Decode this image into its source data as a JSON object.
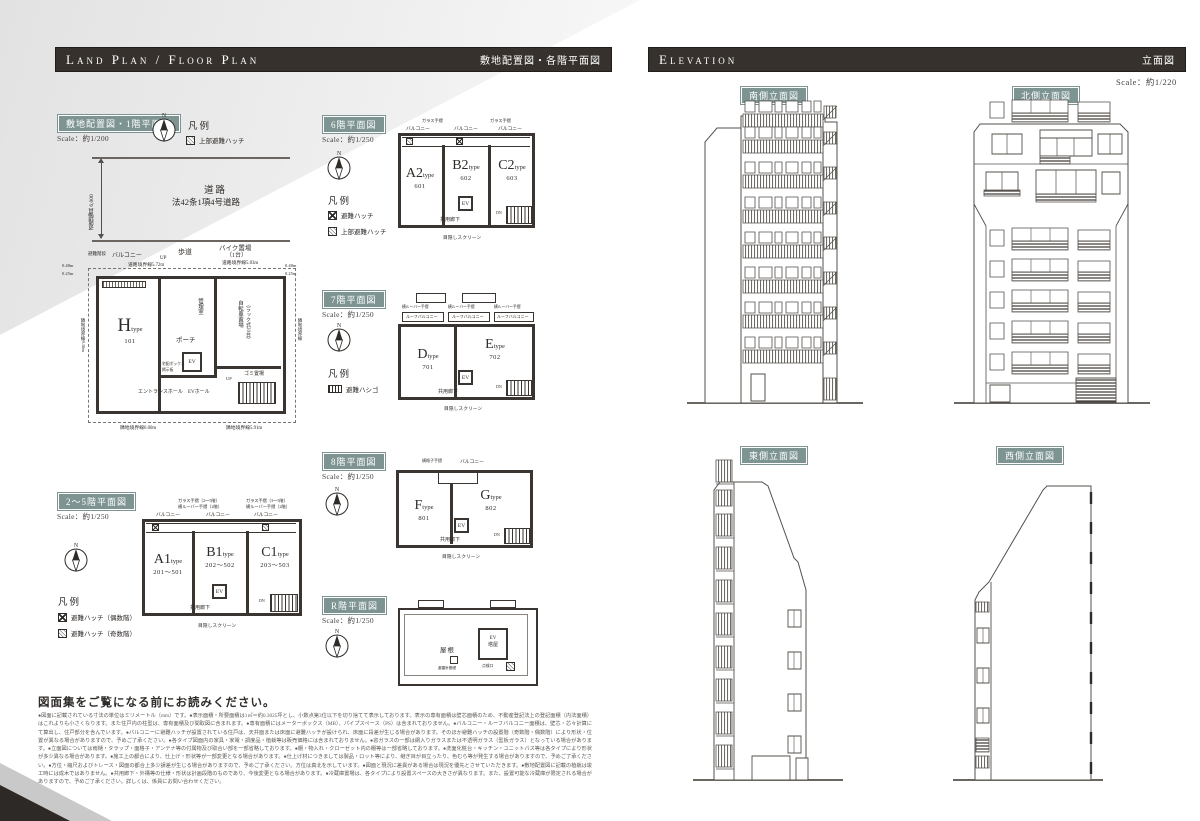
{
  "common": {
    "n": "N",
    "type_word": "type",
    "ev": "EV",
    "corridor": "共用廊下",
    "screen": "目隠しスクリーン",
    "up": "UP",
    "dn": "DN"
  },
  "header": {
    "left_title": "Land Plan / Floor Plan",
    "left_sub": "敷地配置図・各階平面図",
    "right_title": "Elevation",
    "right_sub": "立面図",
    "right_scale": "Scale：約1/220"
  },
  "sections": {
    "site": {
      "label": "敷地配置図・1階平面図",
      "scale": "Scale：約1/200"
    },
    "f25": {
      "label": "2～5階平面図",
      "scale": "Scale：約1/250"
    },
    "f6": {
      "label": "6階平面図",
      "scale": "Scale：約1/250"
    },
    "f7": {
      "label": "7階平面図",
      "scale": "Scale：約1/250"
    },
    "f8": {
      "label": "8階平面図",
      "scale": "Scale：約1/250"
    },
    "fr": {
      "label": "R階平面図",
      "scale": "Scale：約1/250"
    },
    "south": "南側立面図",
    "north": "北側立面図",
    "east": "東側立面図",
    "west": "西側立面図",
    "legend_word": "凡例"
  },
  "legend": {
    "site": [
      "上部避難ハッチ"
    ],
    "f25": [
      "避難ハッチ（偶数階）",
      "避難ハッチ（奇数階）"
    ],
    "f6": [
      "避難ハッチ",
      "上部避難ハッチ"
    ],
    "f7": [
      "避難ハシゴ"
    ]
  },
  "units": {
    "h": {
      "t": "H",
      "n": "101"
    },
    "a1": {
      "t": "A1",
      "n": "201～501"
    },
    "b1": {
      "t": "B1",
      "n": "202～502"
    },
    "c1": {
      "t": "C1",
      "n": "203～503"
    },
    "a2": {
      "t": "A2",
      "n": "601"
    },
    "b2": {
      "t": "B2",
      "n": "602"
    },
    "c2": {
      "t": "C2",
      "n": "603"
    },
    "d": {
      "t": "D",
      "n": "701"
    },
    "e": {
      "t": "E",
      "n": "702"
    },
    "f": {
      "t": "F",
      "n": "801"
    },
    "g": {
      "t": "G",
      "n": "802"
    }
  },
  "site_plan": {
    "road_width": "道路幅員 6,000",
    "road1": "道路",
    "road2": "法42条1項4号道路",
    "sidewalk": "歩道",
    "bike": "バイク置場",
    "bike2": "（1台）",
    "hinan": "避難階段",
    "balcony": "バルコニー",
    "porch": "ポーチ",
    "kanri": "管理室",
    "bicycle": "自転車置場",
    "bicycle2": "（ラック式20台）",
    "evhall": "EVホール",
    "entrance": "エントランスホール",
    "gomi": "ゴミ置場",
    "takuhai": "宅配ボックス",
    "keiji": "掲示板",
    "dims": {
      "tl": "道路境界線5.72m",
      "tr": "道路境界線5.83m",
      "l": "隣地境界線9.10m",
      "r": "隣地境界線",
      "bl": "隣地境界線6.00m",
      "br": "隣地境界線5.91m",
      "c1": "0.48m",
      "c2": "0.25m",
      "c3": "0.48m",
      "c4": "0.25m"
    }
  },
  "plans": {
    "f25_top": [
      "ガラス手摺（2～5階）",
      "横ルーバー手摺（2階）",
      "バルコニー",
      "バルコニー",
      "ガラス手摺（3～5階）",
      "横ルーバー手摺（2階）",
      "バルコニー"
    ],
    "f6_top": [
      "ガラス手摺",
      "バルコニー",
      "バルコニー",
      "ガラス手摺",
      "バルコニー"
    ],
    "f7_top": [
      "横ルーバー手摺",
      "ルーフバルコニー",
      "横ルーバー手摺",
      "ルーフバルコニー",
      "横ルーバー手摺",
      "ルーフバルコニー"
    ],
    "f8_top": [
      "横格子手摺",
      "バルコニー"
    ],
    "fr_labels": {
      "roof": "屋根",
      "ev1": "EV",
      "ev2": "塔屋",
      "raishin": "避雷針基礎",
      "tenken": "点検口"
    }
  },
  "notice": {
    "title": "図面集をご覧になる前にお読みください。",
    "body": "●図面に記載されている寸法の単位はミリメートル（mm）です。●表示面積・所要面積は1㎡＝約0.3025坪とし、小数点第3位以下を切り捨てて表示しております。表示の専有面積は壁芯面積のため、不動産登記法上の登記面積（内法面積）はこれよりも小さくなります。また住戸内の柱型は、専有面積及び間取図に含まれます。●専有面積にはメーターボックス（MB）、パイプスペース（PS）は含まれておりません。●バルコニー・ルーフバルコニー面積は、壁芯・芯々計算にて算出し、住戸部分を含んでいます。●バルコニーに避難ハッチが設置されている住戸は、天井面または床面に避難ハッチが設けられ、床面に段差が生じる場合があります。そのほか避難ハッチの設置階（奇数階・偶数階）により形状・位置が異なる場合がありますので、予めご了承ください。●各タイプ図面内の家具・家電・調度品・植栽等は販売価格には含まれておりません。●窓ガラスの一部は網入りガラスまたは不透明ガラス（型板ガラス）となっている場合があります。●立面図については雨樋・タラップ・面格子・アンテナ等の付属物及び取合い部を一部省略しております。●棚・物入れ・クローゼット内の棚等は一部省略しております。●洗面化粧台・キッチン・ユニットバス等は各タイプにより形状が多少異なる場合があります。●施工上の都合により、仕上げ・形状等が一部変更となる場合があります。●仕上げ材につきましては製品・ロット等により、継ぎ目が目立ったり、色むら等が発生する場合がありますので、予めご了承ください。●方位・縮尺およびトレース・図面の都合上多少誤差が生じる場合がありますので、予めご了承ください。方位は真北を示しています。●図面と現況に差異がある場合は現況を優先とさせていただきます。●敷地配置図に記載の植栽は竣工時には成木ではありません。●共用廊下・外構等の仕様・形状は計画段階のものであり、今後変更となる場合があります。●冷蔵庫置場は、各タイプにより設置スペースの大きさが異なります。また、設置可能な冷蔵庫が限定される場合がありますので、予めご了承ください。詳しくは、係員にお問い合わせください。"
  }
}
